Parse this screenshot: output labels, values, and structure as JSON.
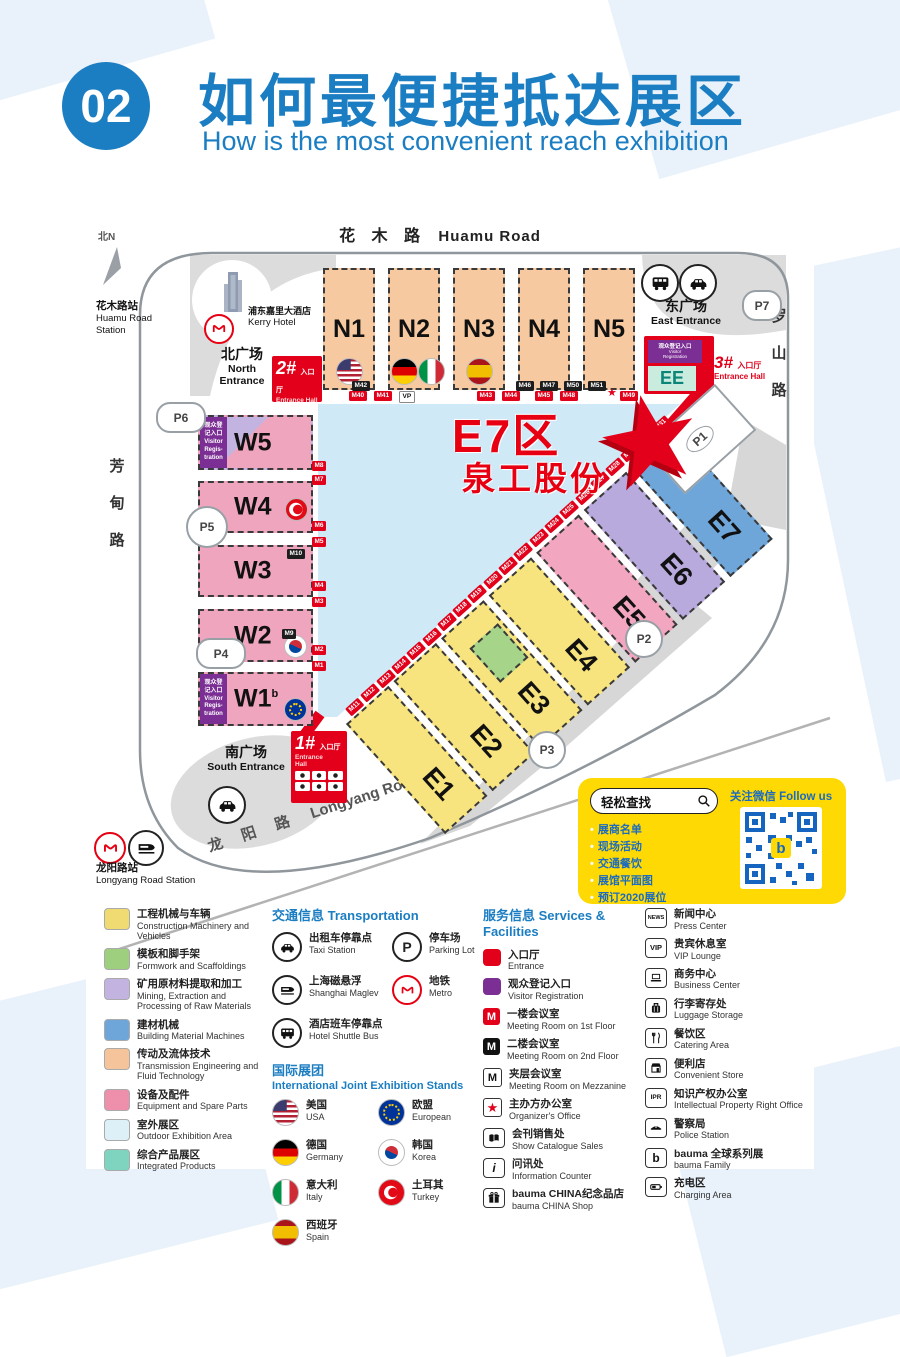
{
  "header": {
    "badge": "02",
    "title_zh": "如何最便捷抵达展区",
    "title_en": "How is the most convenient reach exhibition"
  },
  "map": {
    "compass": "北N",
    "roads": {
      "huamu_zh": "花 木 路",
      "huamu_en": "Huamu Road",
      "fangdian_zh": [
        "芳",
        "甸",
        "路"
      ],
      "fangdian_en": "Fangdian Road",
      "luoshan_zh": [
        "罗",
        "山",
        "路"
      ],
      "luoshan_en": "Luoshan Road",
      "longyang_zh": "龙 阳 路",
      "longyang_en": "Longyang Road"
    },
    "stations": {
      "huamu_zh": "花木路站",
      "huamu_en1": "Huamu Road",
      "huamu_en2": "Station",
      "longyang_zh": "龙阳路站",
      "longyang_en": "Longyang Road Station"
    },
    "hotel": {
      "zh": "浦东嘉里大酒店",
      "en": "Kerry Hotel"
    },
    "plazas": {
      "north_zh": "北广场",
      "north_en1": "North",
      "north_en2": "Entrance",
      "south_zh": "南广场",
      "south_en": "South Entrance",
      "east_zh": "东广场",
      "east_en": "East Entrance"
    },
    "entrances": {
      "one": "1#",
      "two": "2#",
      "three": "3#",
      "hall_zh": "入口厅",
      "hall_en": "Entrance Hall",
      "hall_en1": "Entrance",
      "hall_en2": "Hall"
    },
    "visitor_reg": {
      "zh": "观众登记入口",
      "en1": "Visitor",
      "en2": "Registration",
      "lines": [
        "观众登",
        "记入口",
        "Visitor",
        "Regis-",
        "tration"
      ]
    },
    "halls_n": [
      "N1",
      "N2",
      "N3",
      "N4",
      "N5"
    ],
    "halls_w": [
      "W5",
      "W4",
      "W3",
      "W2",
      "W1"
    ],
    "halls_e": [
      {
        "label": "E1",
        "color": "#f8e47e"
      },
      {
        "label": "E2",
        "color": "#f8e47e"
      },
      {
        "label": "E3",
        "color": "#f8e47e"
      },
      {
        "label": "E4",
        "color": "#f8e47e"
      },
      {
        "label": "E5",
        "color": "#f2a6c0"
      },
      {
        "label": "E6",
        "color": "#b9aade"
      },
      {
        "label": "E7",
        "color": "#6fa6da"
      }
    ],
    "hall_ee": "EE",
    "parking": {
      "p1": "P1",
      "p2": "P2",
      "p3": "P3",
      "p4": "P4",
      "p5": "P5",
      "p6": "P6",
      "p7": "P7"
    },
    "highlight": {
      "area": "E7区",
      "company": "泉工股份"
    },
    "badges": {
      "top_dark": "M42",
      "top_red_a": [
        "M40",
        "M41"
      ],
      "vp": "VP",
      "top_red_b": [
        "M43",
        "M44"
      ],
      "top_dark_b": [
        "M46",
        "M47",
        "M50",
        "M51"
      ],
      "top_red_c": [
        "M45",
        "M48"
      ],
      "star": "★",
      "top_red_d": "M49",
      "left": [
        "M8",
        "M7",
        "M6",
        "M5",
        "M4",
        "M3",
        "M2",
        "M1"
      ],
      "m10": "M10",
      "m9": "M9",
      "ipr_small": "IPR",
      "w1_sup": "b",
      "diag": [
        "M11",
        "M12",
        "M13",
        "M14",
        "M15",
        "M16",
        "M17",
        "M18",
        "M19",
        "M20",
        "M21",
        "M22",
        "M23",
        "M24",
        "M25",
        "M26",
        "M27",
        "M28",
        "M29",
        "M30",
        "M31"
      ]
    }
  },
  "infobox": {
    "search": "轻松查找",
    "items": [
      "展商名单",
      "现场活动",
      "交通餐饮",
      "展馆平面图",
      "预订2020展位"
    ],
    "follow": "关注微信 Follow us",
    "qr_letter": "b"
  },
  "legend": {
    "icon_labels": {
      "m": "M",
      "news": "NEWS",
      "vip": "VIP",
      "ipr": "IPR",
      "p": "P",
      "i": "i",
      "b": "b"
    },
    "categories": [
      {
        "zh": "工程机械与车辆",
        "en": "Construction Machinery and Vehicles",
        "color": "#f0db72"
      },
      {
        "zh": "模板和脚手架",
        "en": "Formwork and Scaffoldings",
        "color": "#9ecf7f"
      },
      {
        "zh": "矿用原材料提取和加工",
        "en": "Mining, Extraction and Processing of Raw Materials",
        "color": "#c3b3e0"
      },
      {
        "zh": "建材机械",
        "en": "Building Material Machines",
        "color": "#6fa6da"
      },
      {
        "zh": "传动及流体技术",
        "en": "Transmission Engineering and Fluid Technology",
        "color": "#f6c49a"
      },
      {
        "zh": "设备及配件",
        "en": "Equipment and Spare Parts",
        "color": "#ee8fac"
      },
      {
        "zh": "室外展区",
        "en": "Outdoor Exhibition Area",
        "color": "#ddf0f8"
      },
      {
        "zh": "综合产品展区",
        "en": "Integrated Products",
        "color": "#7fd4bf"
      }
    ],
    "transport": {
      "title_zh": "交通信息",
      "title_en": "Transportation",
      "taxi": {
        "zh": "出租车停靠点",
        "en": "Taxi Station"
      },
      "maglev": {
        "zh": "上海磁悬浮",
        "en": "Shanghai Maglev"
      },
      "shuttle": {
        "zh": "酒店班车停靠点",
        "en": "Hotel Shuttle Bus"
      },
      "parking": {
        "zh": "停车场",
        "en": "Parking Lot"
      },
      "metro": {
        "zh": "地铁",
        "en": "Metro"
      }
    },
    "international": {
      "title_zh": "国际展团",
      "title_en": "International Joint Exhibition Stands",
      "usa": {
        "zh": "美国",
        "en": "USA"
      },
      "germany": {
        "zh": "德国",
        "en": "Germany"
      },
      "italy": {
        "zh": "意大利",
        "en": "Italy"
      },
      "spain": {
        "zh": "西班牙",
        "en": "Spain"
      },
      "eu": {
        "zh": "欧盟",
        "en": "European"
      },
      "korea": {
        "zh": "韩国",
        "en": "Korea"
      },
      "turkey": {
        "zh": "土耳其",
        "en": "Turkey"
      }
    },
    "services": {
      "title_zh": "服务信息",
      "title_en": "Services & Facilities",
      "entrance": {
        "zh": "入口厅",
        "en": "Entrance"
      },
      "visitor": {
        "zh": "观众登记入口",
        "en": "Visitor Registration"
      },
      "meeting1": {
        "zh": "一楼会议室",
        "en": "Meeting Room on 1st Floor"
      },
      "meeting2": {
        "zh": "二楼会议室",
        "en": "Meeting Room on 2nd Floor"
      },
      "meetingm": {
        "zh": "夹层会议室",
        "en": "Meeting Room on Mezzanine"
      },
      "organizer": {
        "zh": "主办方办公室",
        "en": "Organizer's Office"
      },
      "catalogue": {
        "zh": "会刊销售处",
        "en": "Show Catalogue Sales"
      },
      "info": {
        "zh": "问讯处",
        "en": "Information Counter"
      },
      "shop": {
        "zh": "bauma CHINA纪念品店",
        "en": "bauma CHINA Shop"
      }
    },
    "facilities": {
      "news": {
        "zh": "新闻中心",
        "en": "Press Center"
      },
      "vip": {
        "zh": "贵宾休息室",
        "en": "VIP Lounge"
      },
      "business": {
        "zh": "商务中心",
        "en": "Business Center"
      },
      "luggage": {
        "zh": "行李寄存处",
        "en": "Luggage Storage"
      },
      "catering": {
        "zh": "餐饮区",
        "en": "Catering Area"
      },
      "store": {
        "zh": "便利店",
        "en": "Convenient Store"
      },
      "ipr": {
        "zh": "知识产权办公室",
        "en": "Intellectual Property Right Office"
      },
      "police": {
        "zh": "警察局",
        "en": "Police Station"
      },
      "bauma": {
        "zh": "bauma 全球系列展",
        "en": "bauma Family"
      },
      "charging": {
        "zh": "充电区",
        "en": "Charging Area"
      }
    }
  }
}
